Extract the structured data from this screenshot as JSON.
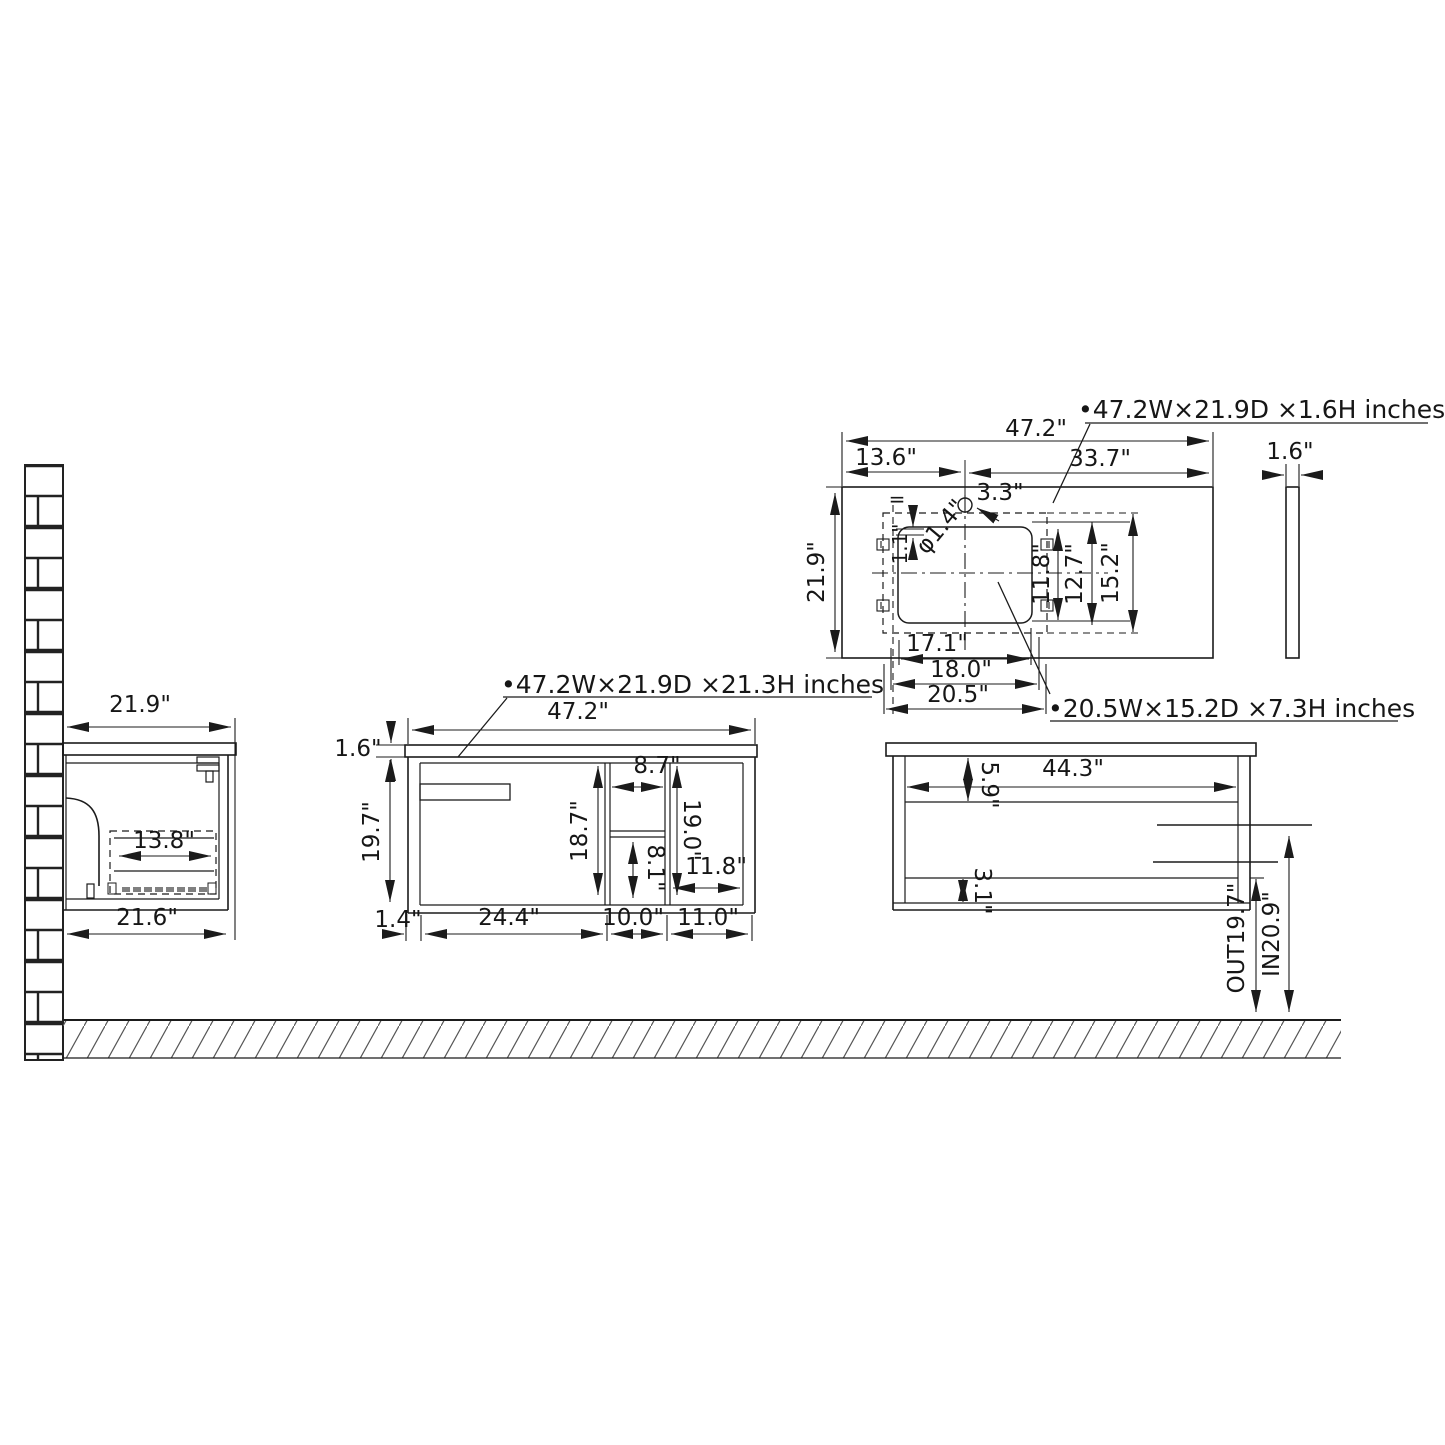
{
  "labels": {
    "counter_spec": "•47.2W×21.9D  ×1.6H  inches",
    "vanity_spec": "•47.2W×21.9D  ×21.3H  inches",
    "sink_spec": "•20.5W×15.2D  ×7.3H  inches"
  },
  "side_view": {
    "depth": "21.9\"",
    "drawer_depth": "13.8\"",
    "bottom_depth": "21.6\""
  },
  "front_view": {
    "width": "47.2\"",
    "counter_thickness": "1.6\"",
    "cabinet_height": "19.7\"",
    "interior_height": "18.7\"",
    "shelf_width": "8.7\"",
    "shelf_column_height": "19.0\"",
    "lower_shelf_height": "8.1\"",
    "right_opening_width": "11.8\"",
    "panel_thickness": "1.4\"",
    "door_width": "24.4\"",
    "shelf_section_width": "10.0\"",
    "right_section_width": "11.0\""
  },
  "top_view": {
    "width": "47.2\"",
    "faucet_from_left": "13.6\"",
    "faucet_from_right": "33.7\"",
    "faucet_from_back": "3.3\"",
    "faucet_hole_dia": "φ1.4\"",
    "equal_mark": "=",
    "edge_gap": "1.1\"",
    "depth": "21.9\"",
    "sink_inner_depth": "11.8\"",
    "sink_mid_depth": "12.7\"",
    "sink_depth": "15.2\"",
    "sink_inner_width": "17.1\"",
    "sink_mid_width": "18.0\"",
    "sink_width": "20.5\"",
    "counter_thickness": "1.6\""
  },
  "back_view": {
    "inner_width": "44.3\"",
    "top_rail_height": "5.9\"",
    "bottom_rail_height": "3.1\"",
    "drain_out_height": "OUT19.7\"",
    "water_in_height": "IN20.9\""
  }
}
